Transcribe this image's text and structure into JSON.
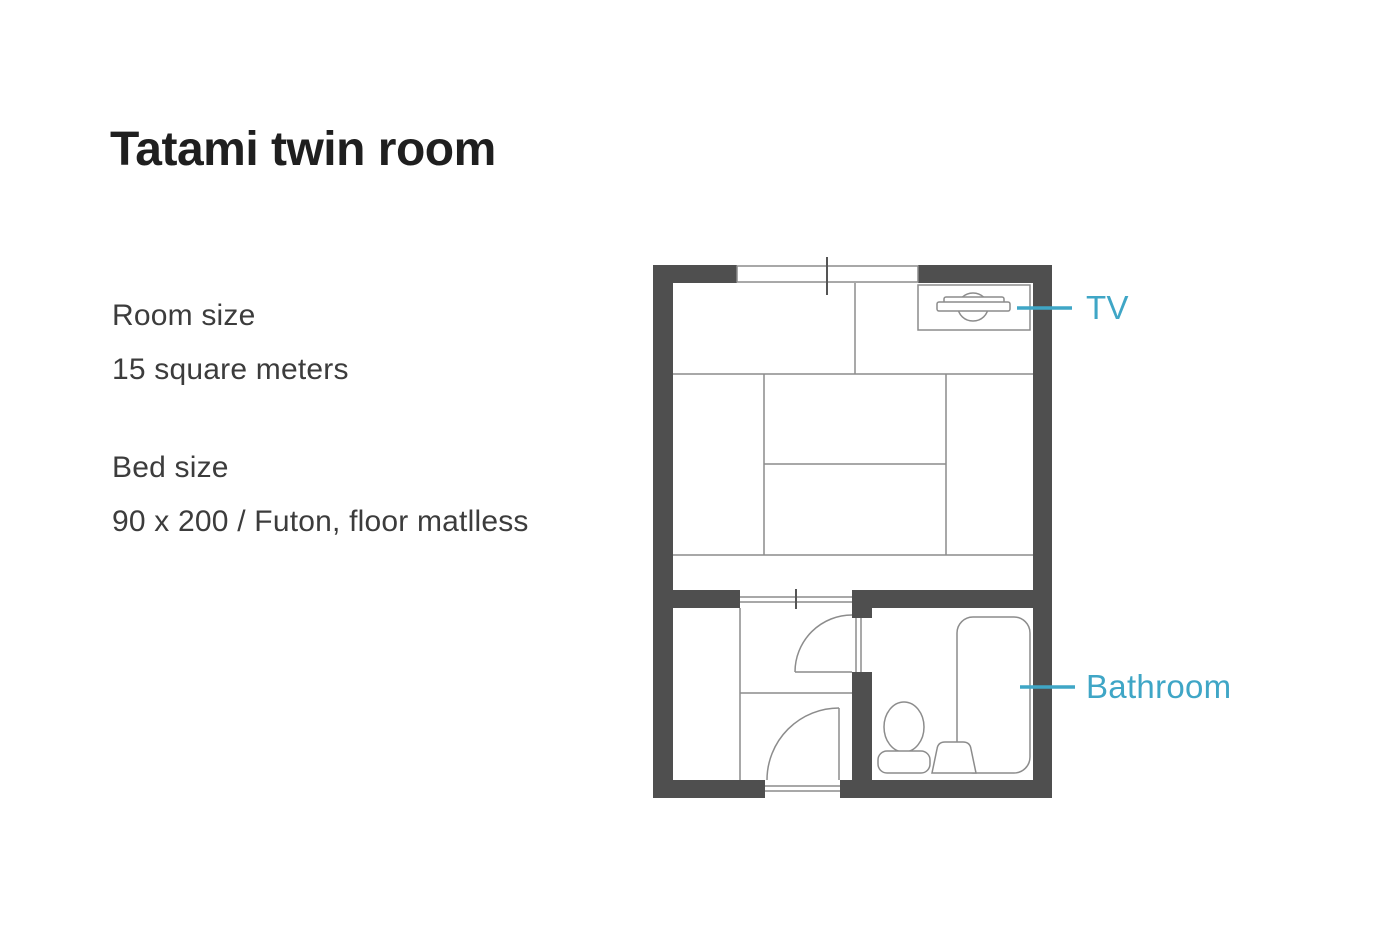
{
  "colors": {
    "accent": "#3FA6C6",
    "wall": "#4F4F4F",
    "line": "#8C8C8C",
    "heading": "#1F1F1F",
    "body": "#3C3C3C"
  },
  "title": "Tatami twin room",
  "specs": [
    {
      "label": "Room size",
      "value": "15 square meters"
    },
    {
      "label": "Bed size",
      "value": "90 x 200 / Futon, floor matlless"
    }
  ],
  "floorplan": {
    "labels": {
      "tv": "TV",
      "bathroom": "Bathroom"
    },
    "features": [
      "window",
      "tatami-mats",
      "tv",
      "sliding-door",
      "closet",
      "bathroom-door",
      "entrance-door",
      "bathtub",
      "toilet",
      "washbasin"
    ]
  }
}
